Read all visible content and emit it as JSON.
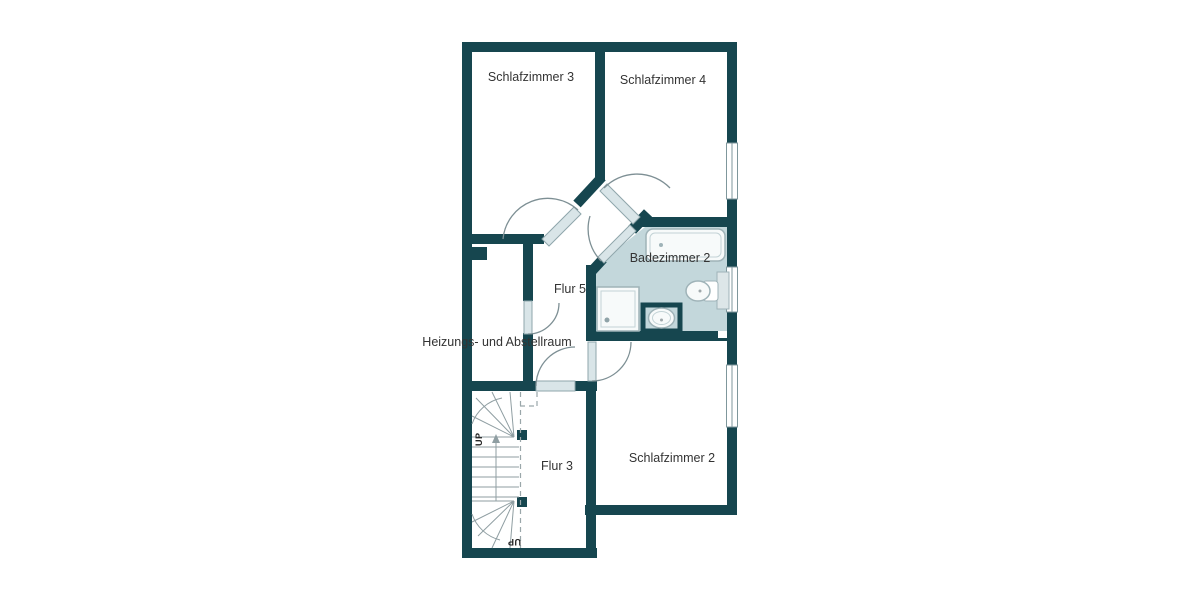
{
  "floorplan": {
    "rooms": [
      {
        "id": "schlafzimmer3",
        "label": "Schlafzimmer 3"
      },
      {
        "id": "schlafzimmer4",
        "label": "Schlafzimmer 4"
      },
      {
        "id": "badezimmer2",
        "label": "Badezimmer 2"
      },
      {
        "id": "flur5",
        "label": "Flur 5"
      },
      {
        "id": "heizung",
        "label": "Heizungs- und Abstellraum"
      },
      {
        "id": "flur3",
        "label": "Flur 3"
      },
      {
        "id": "schlafzimmer2",
        "label": "Schlafzimmer 2"
      }
    ],
    "stair_labels": {
      "top": "UP",
      "bottom": "UP"
    },
    "fixtures": [
      {
        "name": "bathtub"
      },
      {
        "name": "shower"
      },
      {
        "name": "washbasin"
      },
      {
        "name": "toilet"
      }
    ],
    "windows": [
      {
        "location": "right wall upper"
      },
      {
        "location": "right wall bathroom"
      },
      {
        "location": "right wall lower"
      }
    ],
    "colors": {
      "wall": "#16464f",
      "bathroom_floor": "#c3d7db",
      "door_leaf": "#d9e5e8",
      "fixture_outline": "#9fb3b8",
      "stair_line": "#8f9ea2",
      "label_text": "#333333"
    }
  }
}
